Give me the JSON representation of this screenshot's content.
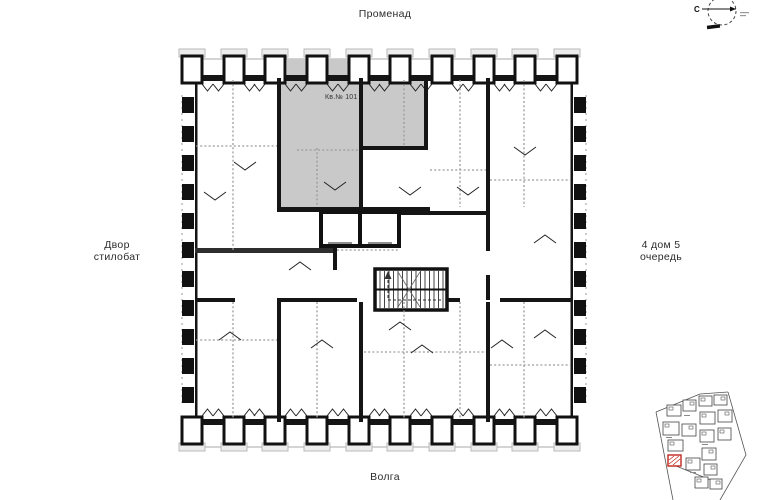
{
  "page": {
    "background": "#ffffff"
  },
  "labels": {
    "top": "Променад",
    "bottom": "Волга",
    "left_line1": "Двор",
    "left_line2": "стилобат",
    "right_line1": "4 дом 5",
    "right_line2": "очередь"
  },
  "plan": {
    "apartment": {
      "label": "Кв.№ 101",
      "fill": "#c9c9c9"
    }
  },
  "compass": {
    "north": "С"
  },
  "minimap": {
    "highlight_color": "#c0271c"
  }
}
